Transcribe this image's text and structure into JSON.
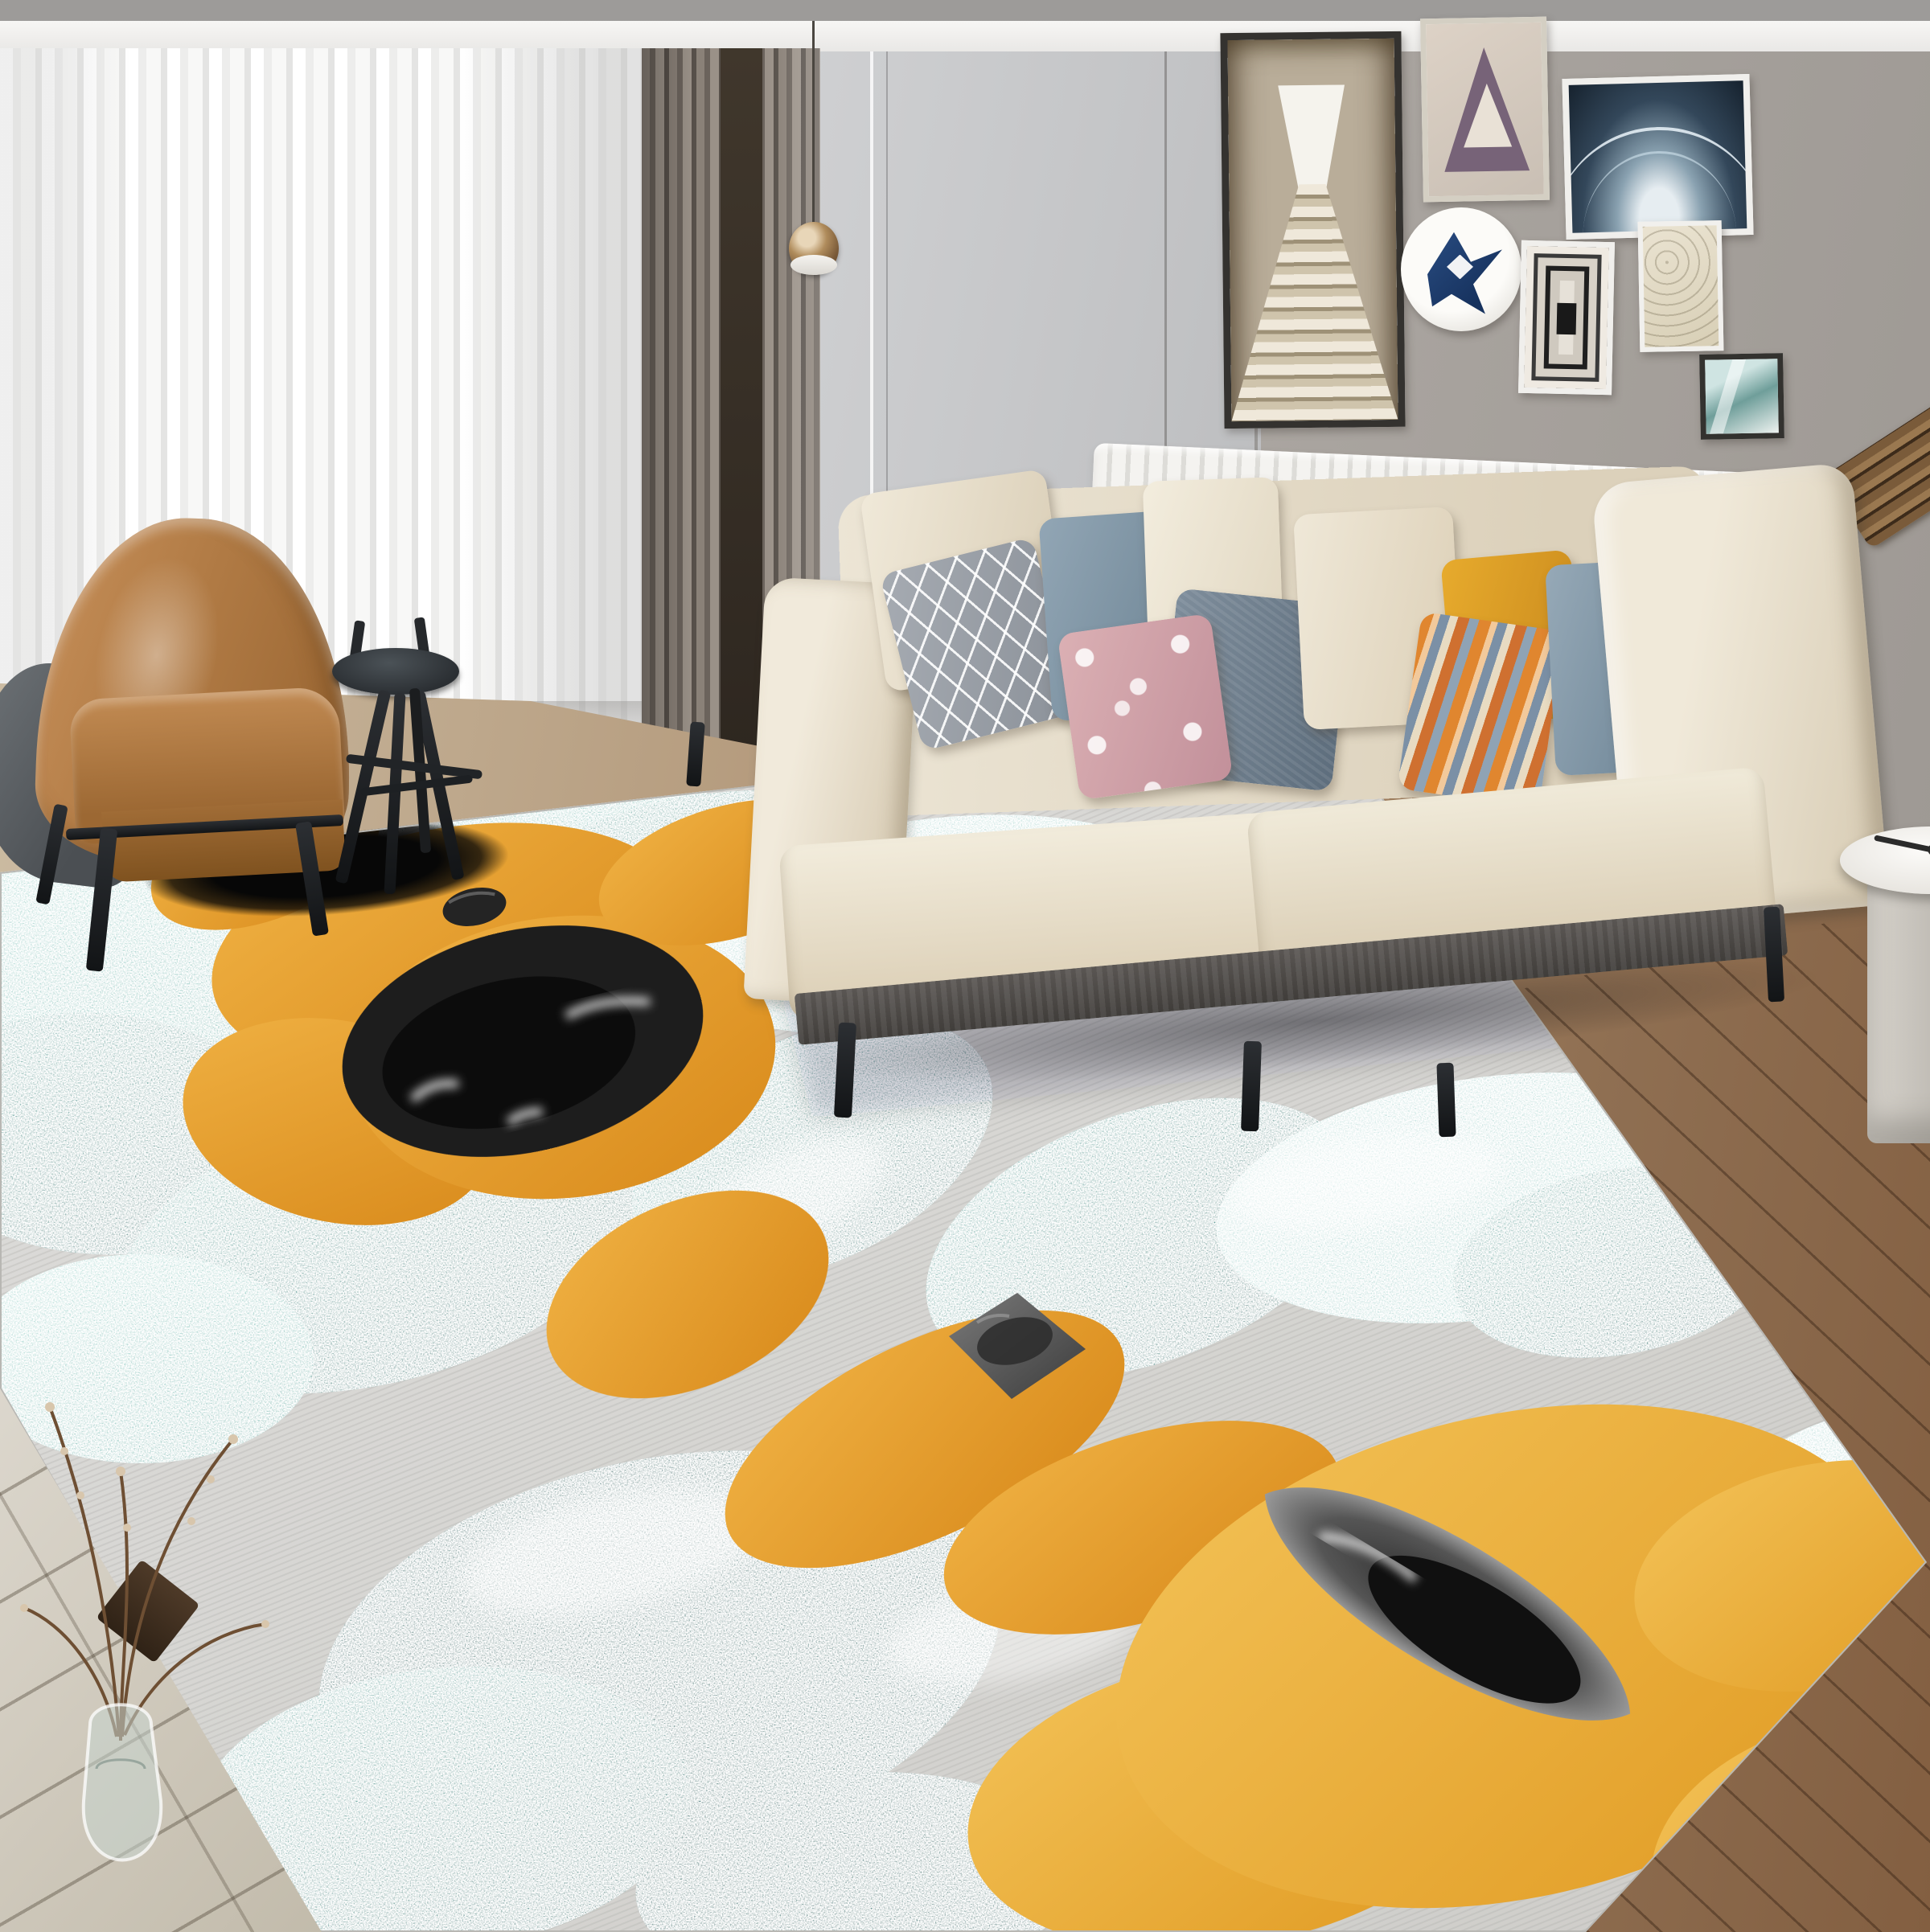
{
  "scene": {
    "label": "Living room product photo of an abstract area rug",
    "room": "modern living room with beige sofa, leather armchair, gallery wall and abstract rug"
  },
  "palette": {
    "wall_right": "#aaa5a0",
    "wall_panel": "#c6c7c9",
    "top_band": "#9d9b99",
    "curtain_sheer": "#f5f5f4",
    "curtain_dark": "#6f6761",
    "sofa_fabric": "#e9e1d0",
    "sofa_base_wood": "#4a4643",
    "armchair_leather": "#b07c45",
    "armchair_shell": "#585c60",
    "stool_black": "#2e3236",
    "radiator_white": "#f2f1ee",
    "floor_left_planks": "#d3cec3",
    "floor_right_planks": "#8f6f52",
    "rug_base_gray": "#d8d7d3",
    "rug_teal": "#4a9d97",
    "rug_teal_deep": "#2e7d79",
    "rug_aqua_light": "#a9ded6",
    "rug_orange": "#e69c28",
    "rug_yellow": "#eeb13f",
    "rug_ink_black": "#1d1d1d"
  },
  "furniture": {
    "sofa": "three-seat beige fabric sofa with wood base and black tapered legs",
    "sofa_pillows": [
      "cream",
      "gray geometric diamond",
      "slate blue",
      "cream",
      "pink floral",
      "dark slate quilted",
      "cream",
      "mustard yellow",
      "multicolor striped",
      "slate blue",
      "cream"
    ],
    "armchair": "caramel leather armchair with dark gray outer shell and black metal legs",
    "stool": "black round tripod stool side table",
    "side_table": "white round side table at right edge",
    "radiator": "white wall radiator with vertical fins",
    "pendant_lamp": "amber glass globe pendant on thin cord",
    "wall_sconce": "angled wooden slat wall lamp"
  },
  "gallery": {
    "frames": [
      {
        "name": "stairs-photo",
        "desc": "tall dark frame, white mat, beige staircase tunnel photo"
      },
      {
        "name": "purple-tunnel",
        "desc": "square light frame with purple triangular tunnel print"
      },
      {
        "name": "xray-arch",
        "desc": "wide white frame with dark blue x-ray arch image"
      },
      {
        "name": "round-plate",
        "desc": "white ceramic plate with blue geometric crane design"
      },
      {
        "name": "bw-tunnel",
        "desc": "small white frame, concentric black rectangles print"
      },
      {
        "name": "beige-abstract",
        "desc": "small white frame with beige squiggle print"
      },
      {
        "name": "teal-abstract",
        "desc": "small dark frame with teal and white image"
      }
    ]
  },
  "rug": {
    "desc": "abstract watercolor rug: gray striated base, granular teal blobs, amber-orange blobs, black ink shapes",
    "shapes": [
      "large black ink oval with white streaks",
      "small black pebble",
      "gray ink diamond",
      "black-gray leaf shape",
      "black oval floor shadow under chair"
    ]
  },
  "decor": {
    "vase": "glass vase with dry willow branches on plank floor",
    "board": "small dark wood board on floor behind vase"
  }
}
